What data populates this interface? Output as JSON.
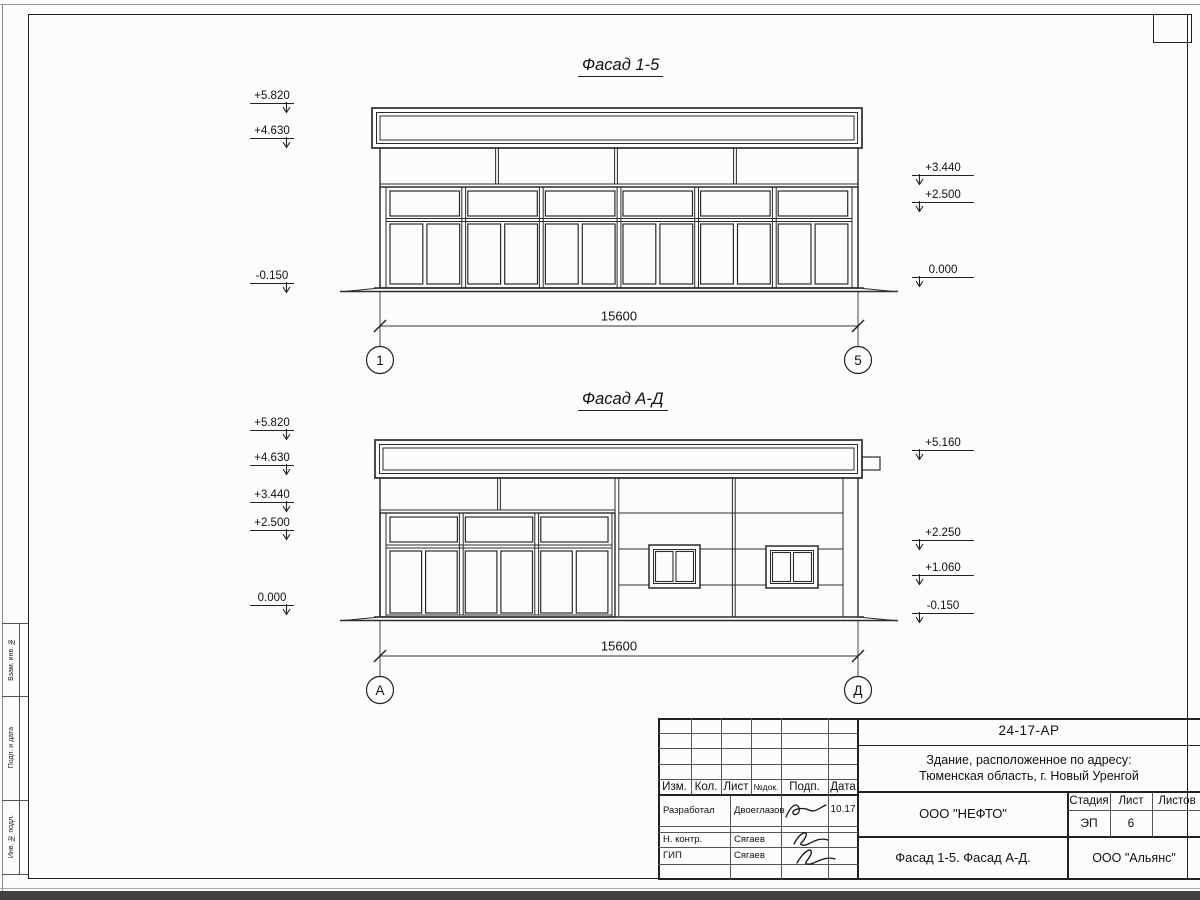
{
  "facade1": {
    "title": "Фасад 1-5",
    "marks_left": [
      "+5.820",
      "+4.630",
      "-0.150"
    ],
    "marks_right": [
      "+3.440",
      "+2.500",
      "0.000"
    ],
    "dim": "15600",
    "axis_left": "1",
    "axis_right": "5"
  },
  "facade2": {
    "title": "Фасад А-Д",
    "marks_left": [
      "+5.820",
      "+4.630",
      "+3.440",
      "+2.500",
      "0.000"
    ],
    "marks_right": [
      "+5.160",
      "+2.250",
      "+1.060",
      "-0.150"
    ],
    "dim": "15600",
    "axis_left": "А",
    "axis_right": "Д"
  },
  "titleblock": {
    "doc_number": "24-17-АР",
    "object_line1": "Здание, расположенное по адресу:",
    "object_line2": "Тюменская область, г. Новый Уренгой",
    "org": "ООО \"НЕФТО\"",
    "drawing_title": "Фасад 1-5. Фасад А-Д.",
    "contractor": "ООО \"Альянс\"",
    "stage_label": "Стадия",
    "sheet_label": "Лист",
    "sheets_label": "Листов",
    "stage": "ЭП",
    "sheet_no": "6",
    "cols": {
      "izm": "Изм.",
      "kol": "Кол.",
      "list": "Лист",
      "ndok": "№док.",
      "podp": "Подп.",
      "data": "Дата"
    },
    "rows": [
      {
        "role": "Разработал",
        "name": "Двоеглазов",
        "date": "10.17"
      },
      {
        "role": "Н. контр.",
        "name": "Сягаев",
        "date": ""
      },
      {
        "role": "ГИП",
        "name": "Сягаев",
        "date": ""
      }
    ]
  },
  "margin": {
    "labels": [
      "Взам. инв. №",
      "Подп. и дата",
      "Инв. № подл."
    ]
  }
}
